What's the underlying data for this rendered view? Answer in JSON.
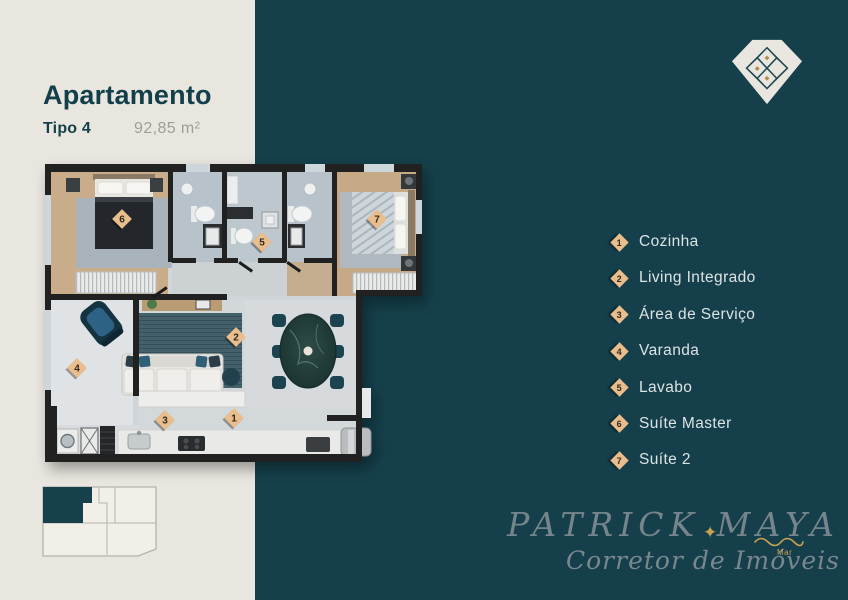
{
  "header": {
    "title": "Apartamento",
    "type_label": "Tipo 4",
    "area_label": "92,85 m²"
  },
  "legend": {
    "items": [
      {
        "num": "1",
        "label": "Cozinha"
      },
      {
        "num": "2",
        "label": "Living Integrado"
      },
      {
        "num": "3",
        "label": "Área de Serviço"
      },
      {
        "num": "4",
        "label": "Varanda"
      },
      {
        "num": "5",
        "label": "Lavabo"
      },
      {
        "num": "6",
        "label": "Suíte Master"
      },
      {
        "num": "7",
        "label": "Suíte 2"
      }
    ]
  },
  "floorplan": {
    "badges": [
      {
        "num": "1",
        "x": 234,
        "y": 418
      },
      {
        "num": "2",
        "x": 236,
        "y": 337
      },
      {
        "num": "3",
        "x": 165,
        "y": 420
      },
      {
        "num": "4",
        "x": 77,
        "y": 368
      },
      {
        "num": "5",
        "x": 262,
        "y": 242
      },
      {
        "num": "6",
        "x": 122,
        "y": 219
      },
      {
        "num": "7",
        "x": 377,
        "y": 219
      }
    ]
  },
  "branding": {
    "name": "PATRICK MAYA",
    "role": "Corretor de Imóveis",
    "mark": "Mar",
    "logo_icon": "diamond-lattice"
  },
  "colors": {
    "cream": "#e9e6df",
    "teal": "#15404b",
    "title_teal": "#133f4a",
    "area_gray": "#9e9e99",
    "badge_tan": "#e9bd8c",
    "badge_text": "#2f2a21",
    "legend_text": "#dce3e3",
    "signature_gray": "#7e8b91",
    "gold": "#c9a152",
    "wall": "#212121",
    "wood_floor": "#c9ad8b"
  }
}
